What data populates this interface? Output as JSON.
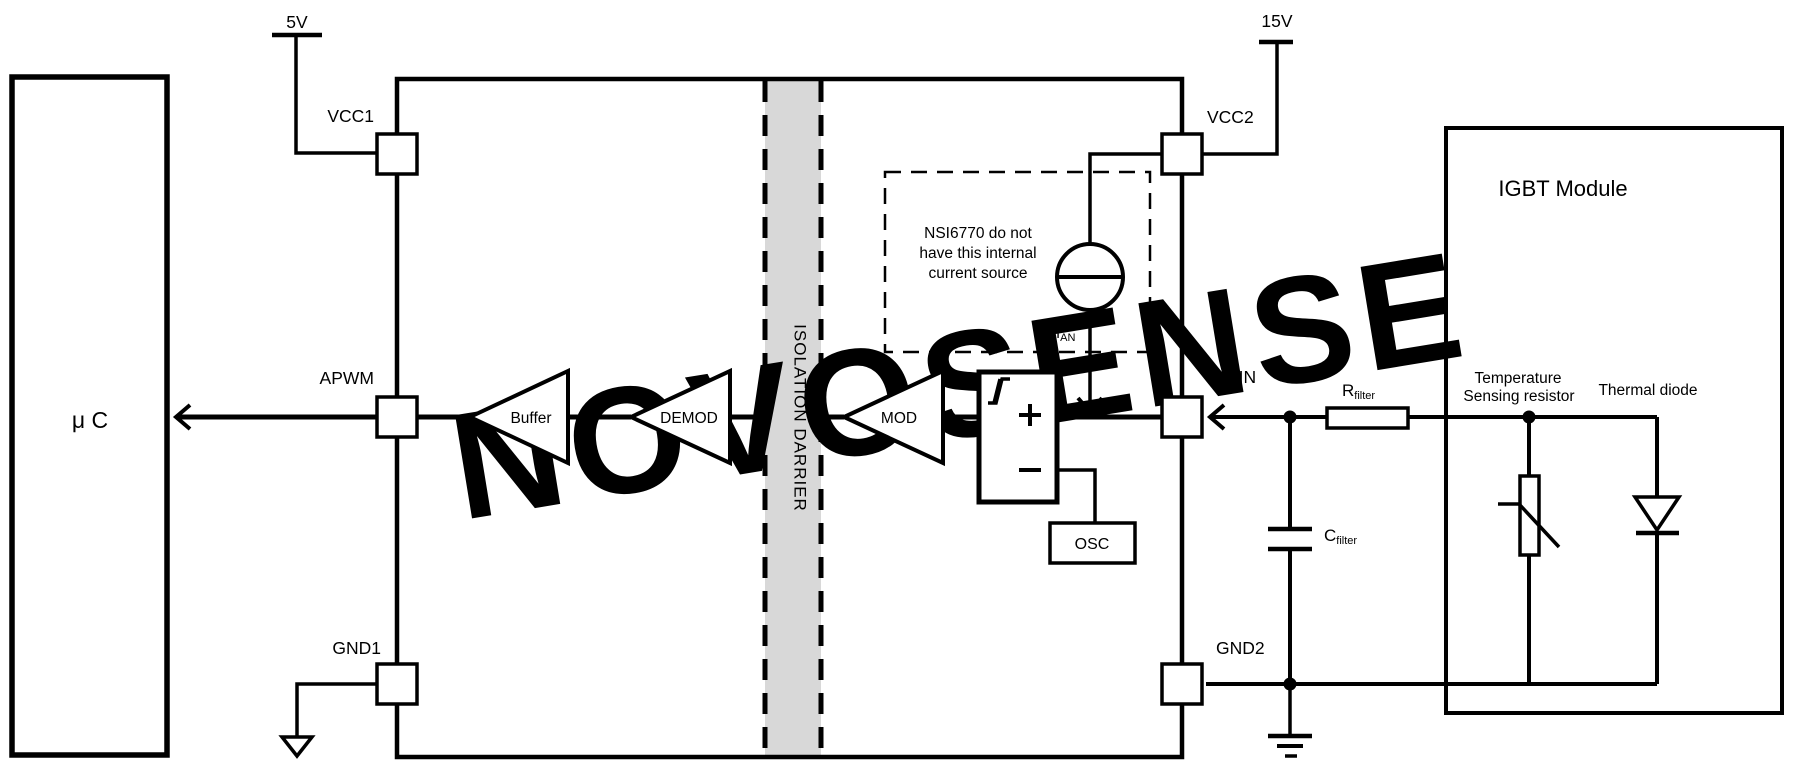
{
  "diagram": {
    "watermark": "NOVOSENSE",
    "supplies": {
      "left": "5V",
      "right": "15V"
    },
    "mcu": {
      "label": "μ C"
    },
    "chip": {
      "pins": {
        "vcc1": "VCC1",
        "apwm": "APWM",
        "gnd1": "GND1",
        "vcc2": "VCC2",
        "ain": "AIN",
        "gnd2": "GND2"
      },
      "blocks": {
        "buffer": "Buffer",
        "demod": "DEMOD",
        "mod": "MOD",
        "osc": "OSC"
      },
      "barrier_label": "ISOLATION DARRIER",
      "note": {
        "line1": "NSI6770 do not",
        "line2": "have this internal",
        "line3": "current source"
      },
      "current_source": {
        "symbol": "I",
        "sub": "AN"
      }
    },
    "external": {
      "rfilter": {
        "symbol": "R",
        "sub": "filter"
      },
      "cfilter": {
        "symbol": "C",
        "sub": "filter"
      }
    },
    "igbt": {
      "title": "IGBT Module",
      "thermistor_label": {
        "line1": "Temperature",
        "line2": "Sensing resistor"
      },
      "diode_label": "Thermal diode"
    },
    "colors": {
      "line": "#000000",
      "barrier_fill": "#d8d8d8",
      "watermark": "#e9e9e9",
      "background": "#ffffff"
    }
  }
}
